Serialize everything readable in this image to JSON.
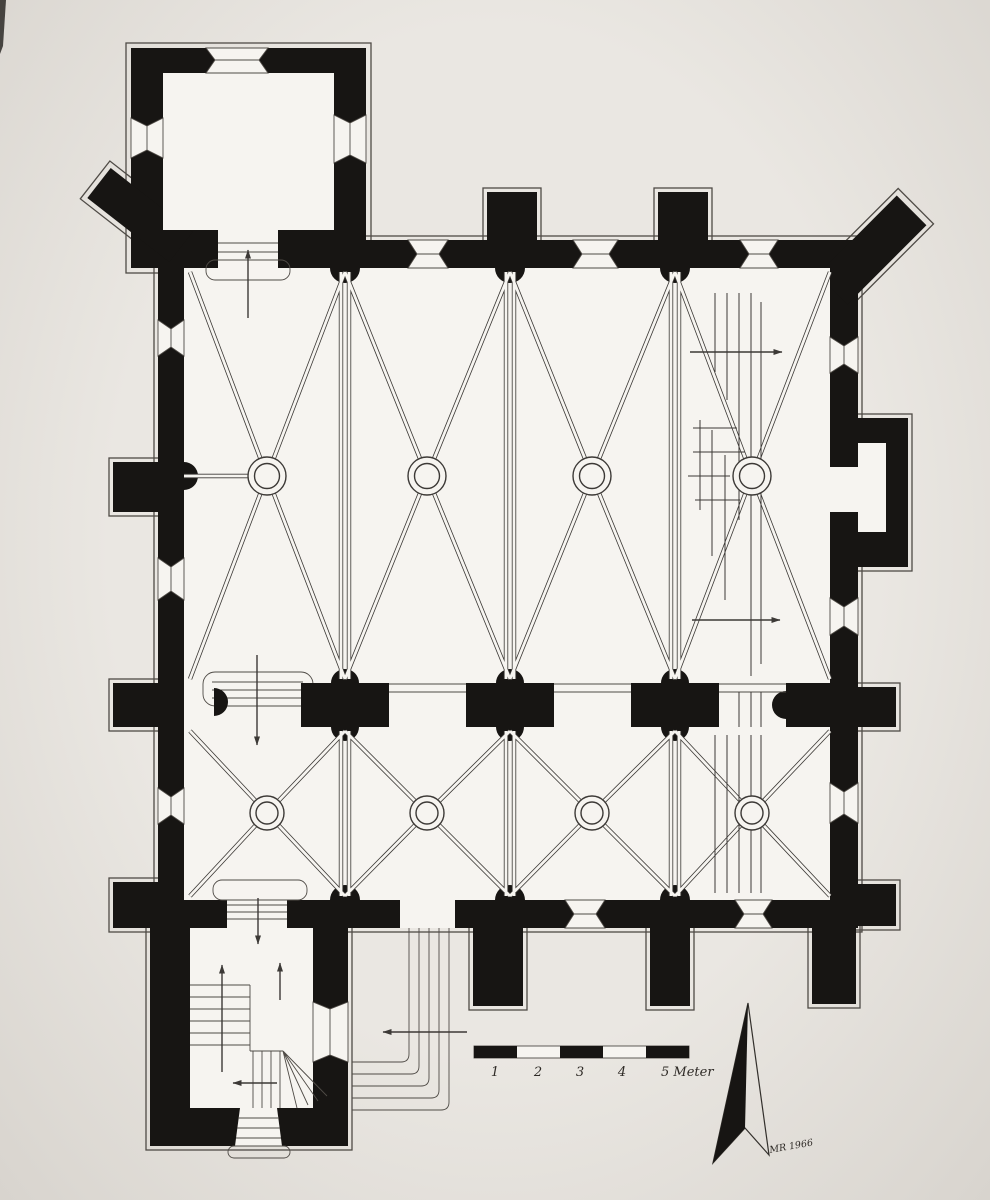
{
  "figure": {
    "description": "Scanned black-ink ground plan of a church: rib-vaulted nave of four bays, side aisle, square tower room at the north-west, entrance porch with staircase at the south-west, buttressed outer walls, circulation arrows, metric scale bar and north arrow."
  },
  "scale_bar": {
    "labels": [
      "1",
      "2",
      "3",
      "4"
    ],
    "unit_label": "5 Meter"
  },
  "signature": {
    "text": "MR 1966"
  },
  "colors": {
    "paper": "#eae7e2",
    "paper_edge": "#d8d4ce",
    "ink": "#171513",
    "floor": "#f6f4f0",
    "line": "#4f4b46",
    "rib": "#3c3936"
  }
}
